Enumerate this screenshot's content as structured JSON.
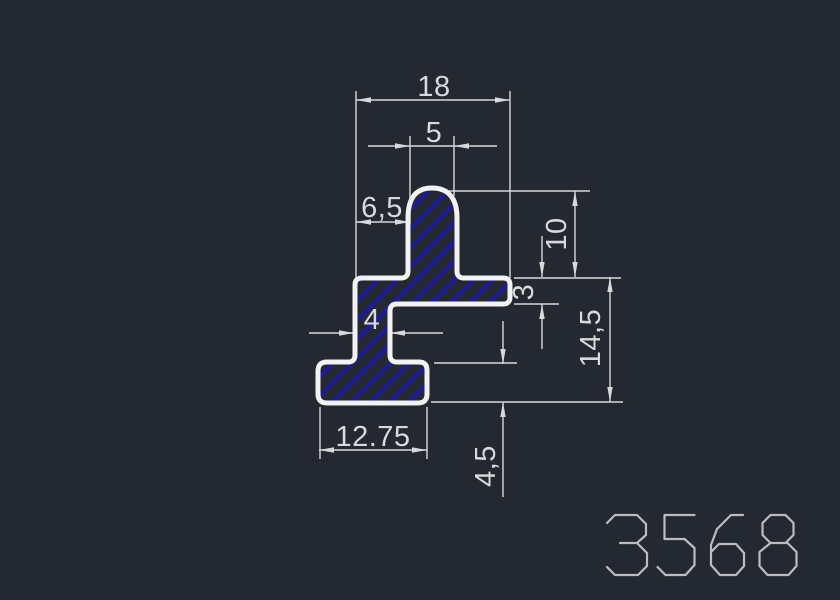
{
  "colors": {
    "background": "#242830",
    "outline": "#f2f2f2",
    "hatch": "#1d1d90",
    "dimension": "#d8d8d8",
    "part_number": "#b9bdc2"
  },
  "dimensions": {
    "overall_width": "18",
    "top_stem_width": "5",
    "left_arm_width": "6,5",
    "stem_height": "10",
    "flange_thickness": "3",
    "web_width": "4",
    "profile_height": "14,5",
    "foot_width": "12.75",
    "foot_height": "4,5"
  },
  "part_number": "3568"
}
